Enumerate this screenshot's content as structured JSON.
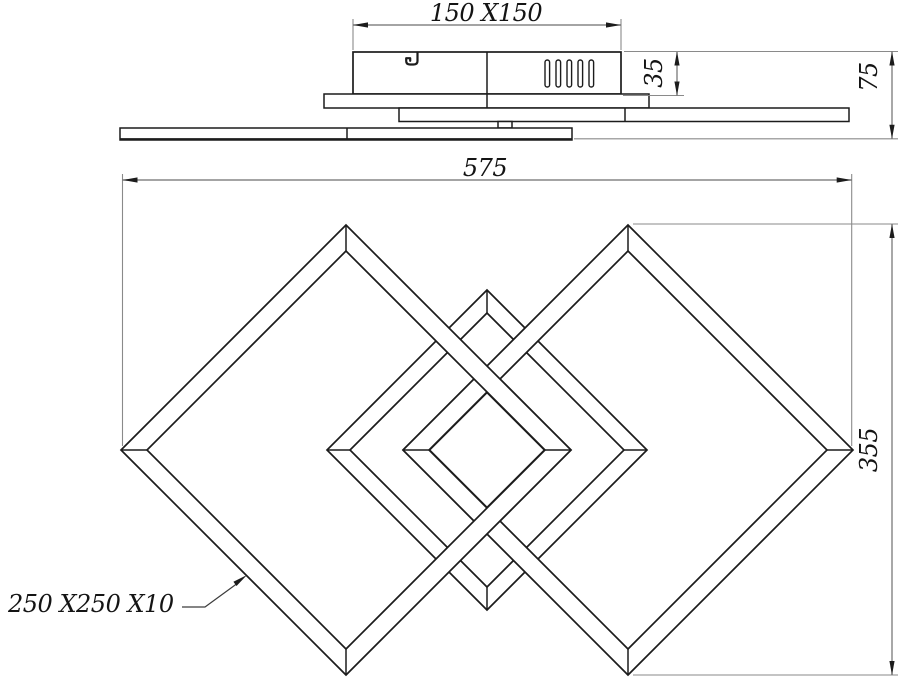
{
  "drawing": {
    "type": "technical-dimension-drawing",
    "subject": "ceiling-light-fixture-with-interlocking-square-frames",
    "background_color": "#ffffff",
    "geometry_line_color": "#1c1c1c",
    "dimension_line_color": "#6e6e6e",
    "side_view": {
      "canopy_dimension": "150 X150",
      "canopy_height": "35",
      "fixture_height": "75"
    },
    "plan_view": {
      "overall_width": "575",
      "overall_height": "355",
      "frame_spec": "250 X250 X10"
    }
  }
}
